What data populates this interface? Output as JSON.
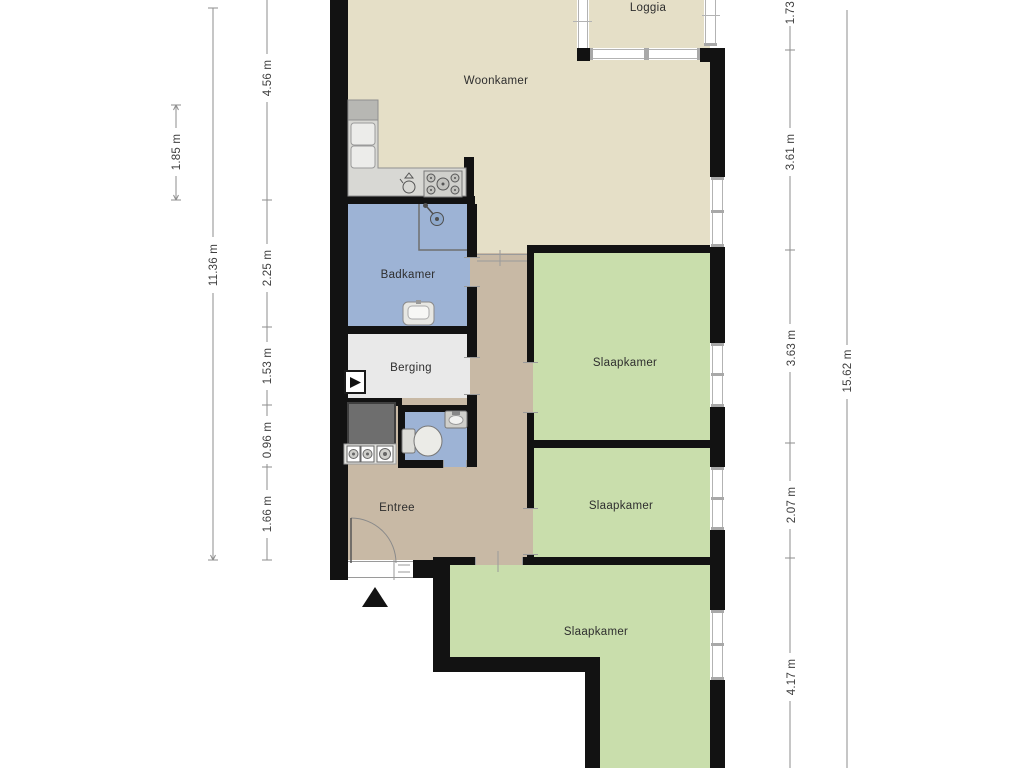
{
  "colors": {
    "room_living": "#e5dfc7",
    "room_hall": "#c8b9a5",
    "room_bedroom": "#c9deac",
    "room_bath": "#9db3d5",
    "room_storage": "#e9e9e9",
    "wall": "#121212",
    "fixture_light": "#d8d8d4",
    "fixture_dark": "#6e6e6e",
    "dim_line": "#8e8e8e",
    "dim_text": "#3e3e3e",
    "label_text": "#2e2e2e"
  },
  "rooms": {
    "woonkamer": {
      "label": "Woonkamer"
    },
    "loggia": {
      "label": "Loggia"
    },
    "badkamer": {
      "label": "Badkamer"
    },
    "berging": {
      "label": "Berging"
    },
    "entree": {
      "label": "Entree"
    },
    "slaapkamer_1": {
      "label": "Slaapkamer"
    },
    "slaapkamer_2": {
      "label": "Slaapkamer"
    },
    "slaapkamer_3": {
      "label": "Slaapkamer"
    }
  },
  "dimensions": {
    "left_outer": {
      "label": "1.85 m"
    },
    "left_mid": {
      "label": "11.36 m"
    },
    "left_inner": [
      {
        "label": "4.56 m"
      },
      {
        "label": "2.25 m"
      },
      {
        "label": "1.53 m"
      },
      {
        "label": "0.96 m"
      },
      {
        "label": "1.66 m"
      }
    ],
    "right_inner": [
      {
        "label": "1.73 m"
      },
      {
        "label": "3.61 m"
      },
      {
        "label": "3.63 m"
      },
      {
        "label": "2.07 m"
      },
      {
        "label": "4.17 m"
      }
    ],
    "right_outer": {
      "label": "15.62 m"
    }
  }
}
